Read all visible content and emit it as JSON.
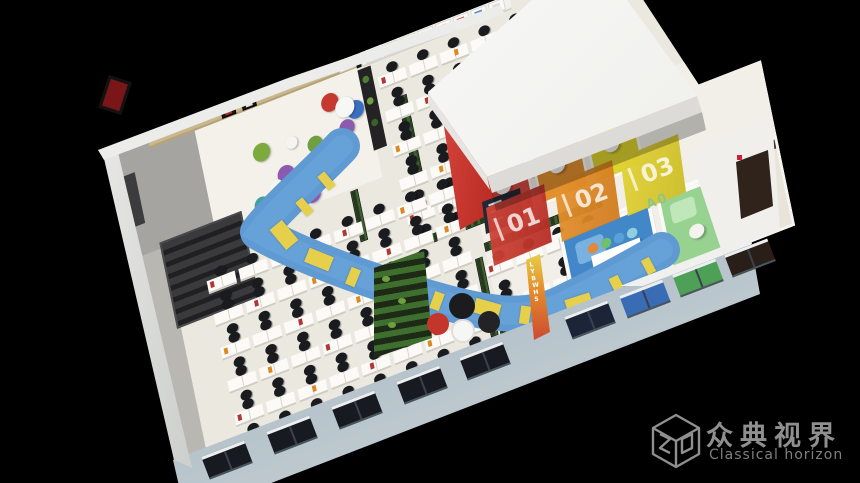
{
  "background": "#000000",
  "scene_type": "3d-isometric-office-floorplan-render",
  "watermark": {
    "brand_cn": "众典视界",
    "brand_en": "Classical horizon",
    "logo": "zd-cube-icon",
    "color": "#8f8f8f"
  },
  "rooms": {
    "booths": [
      {
        "label": "01",
        "floor_color": "#d64a41"
      },
      {
        "label": "02",
        "floor_color": "#e2902f"
      },
      {
        "label": "03",
        "floor_color": "#ddd32f"
      }
    ],
    "green_room_label": "A0",
    "orange_wall_text": "LYBWHS",
    "blue_room_color": "#4287c7",
    "green_room_color": "#97d290",
    "red_wall_color": "#c5333a",
    "walkway_color": "#5f9ad2",
    "walkway_marking_color": "#e6cf4a"
  },
  "floorplan": {
    "desk_zones": [
      {
        "p": 280,
        "q": 20,
        "cols": 5,
        "rows": 5,
        "cw": 33,
        "ch": 35
      },
      {
        "p": 68,
        "q": 150,
        "cols": 8,
        "rows": 5,
        "cw": 34,
        "ch": 34
      },
      {
        "p": 348,
        "q": 238,
        "cols": 4,
        "rows": 2,
        "cw": 32,
        "ch": 39
      }
    ],
    "planters": [
      {
        "p": 296,
        "q": 56,
        "w": 10,
        "h": 84
      },
      {
        "p": 230,
        "q": 128,
        "w": 8,
        "h": 52
      },
      {
        "p": 282,
        "q": 198,
        "w": 120,
        "h": 9
      },
      {
        "p": 446,
        "q": 25,
        "w": 8,
        "h": 70
      },
      {
        "p": 340,
        "q": 238,
        "w": 8,
        "h": 80
      },
      {
        "p": 352,
        "q": 226,
        "w": 126,
        "h": 9
      },
      {
        "p": 350,
        "q": 312,
        "w": 120,
        "h": 8
      }
    ],
    "beanbags": [
      {
        "p": 150,
        "q": 58,
        "r": 9,
        "c": "#7daa3c"
      },
      {
        "p": 170,
        "q": 88,
        "r": 9,
        "c": "#8b5bb1"
      },
      {
        "p": 140,
        "q": 108,
        "r": 8,
        "c": "#3fa0a0"
      },
      {
        "p": 192,
        "q": 116,
        "r": 9,
        "c": "#8b5bb1"
      },
      {
        "p": 205,
        "q": 70,
        "r": 8,
        "c": "#6f9f3f"
      },
      {
        "p": 158,
        "q": 96,
        "r": 7,
        "c": "#f5f4f0"
      },
      {
        "p": 182,
        "q": 60,
        "r": 6,
        "c": "#f5f4f0"
      }
    ],
    "lounge_chairs": [
      {
        "p": 228,
        "q": 36,
        "r": 9,
        "c": "#c5392e"
      },
      {
        "p": 252,
        "q": 52,
        "r": 9,
        "c": "#3a6fc0"
      },
      {
        "p": 240,
        "q": 66,
        "r": 8,
        "c": "#8b5bb1"
      },
      {
        "p": 242,
        "q": 46,
        "r": 10,
        "c": "#f7f7f5"
      }
    ],
    "locker_item_colors": [
      "#c44343",
      "#d9985a",
      "#4477bb",
      "#cccccc",
      "#e88330",
      "#c44343",
      "#5588cc",
      "#dddddd"
    ],
    "conference_chair_colors": [
      "#e08a40",
      "#6fbf6f",
      "#5aa0d8",
      "#8fd0e0"
    ]
  },
  "walkway": {
    "path": "M 342,146 C 318,172 276,208 258,232 C 300,256 378,284 426,297 C 478,312 522,322 560,304 C 596,287 624,272 662,250",
    "width": 36,
    "dashes": [
      {
        "x": 322,
        "y": 172,
        "a": -40,
        "w": 9,
        "h": 18
      },
      {
        "x": 300,
        "y": 198,
        "a": -40,
        "w": 9,
        "h": 18
      },
      {
        "x": 276,
        "y": 222,
        "a": -40,
        "w": 16,
        "h": 26
      },
      {
        "x": 306,
        "y": 252,
        "a": 22,
        "w": 26,
        "h": 15
      },
      {
        "x": 348,
        "y": 268,
        "a": 22,
        "w": 10,
        "h": 18
      },
      {
        "x": 388,
        "y": 280,
        "a": 22,
        "w": 26,
        "h": 15
      },
      {
        "x": 432,
        "y": 292,
        "a": 20,
        "w": 10,
        "h": 18
      },
      {
        "x": 474,
        "y": 301,
        "a": 16,
        "w": 26,
        "h": 15
      },
      {
        "x": 520,
        "y": 306,
        "a": 8,
        "w": 10,
        "h": 18
      },
      {
        "x": 566,
        "y": 296,
        "a": -18,
        "w": 26,
        "h": 15
      },
      {
        "x": 612,
        "y": 276,
        "a": -26,
        "w": 10,
        "h": 18
      },
      {
        "x": 644,
        "y": 258,
        "a": -28,
        "w": 9,
        "h": 16
      }
    ]
  },
  "facade": {
    "wall_color": "#9db0ba",
    "windows": [
      {
        "x": 204,
        "y": 448,
        "c": "#171a20"
      },
      {
        "x": 269,
        "y": 423,
        "c": "#171a20"
      },
      {
        "x": 334,
        "y": 398,
        "c": "#171a20"
      },
      {
        "x": 399,
        "y": 373,
        "c": "#171a20"
      },
      {
        "x": 462,
        "y": 349,
        "c": "#171a20"
      },
      {
        "x": 567,
        "y": 308,
        "c": "#1c2538"
      },
      {
        "x": 622,
        "y": 287,
        "c": "#3a6cb5"
      },
      {
        "x": 675,
        "y": 266,
        "c": "#4da056"
      },
      {
        "x": 727,
        "y": 246,
        "c": "#2a1f18"
      }
    ]
  }
}
